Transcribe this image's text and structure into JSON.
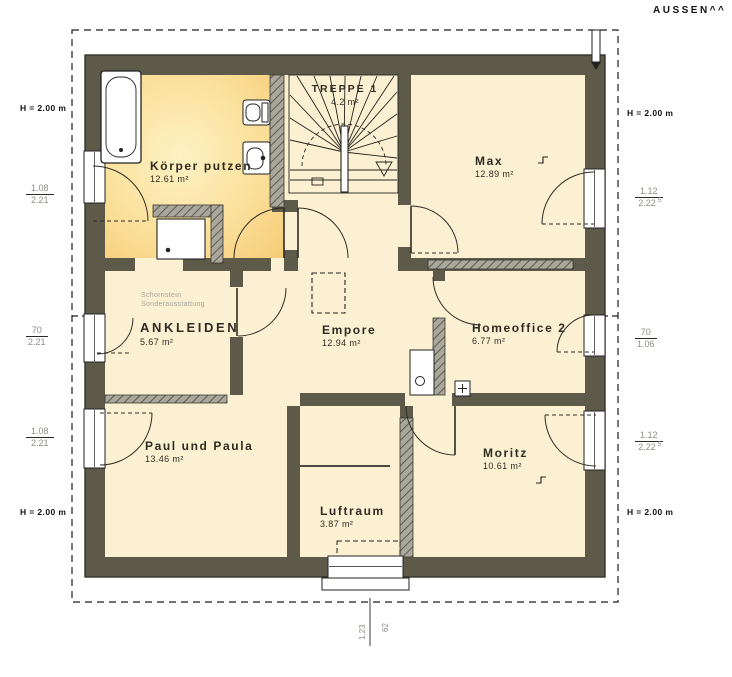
{
  "outside_label": "AUSSEN^^",
  "rooms": {
    "bath": {
      "name": "Körper putzen",
      "area": "12.61 m²"
    },
    "stairs": {
      "name": "TREPPE 1",
      "area": "4.2 m²"
    },
    "max": {
      "name": "Max",
      "area": "12.89 m²"
    },
    "ankleiden": {
      "name": "ANKLEIDEN",
      "area": "5.67 m²"
    },
    "empore": {
      "name": "Empore",
      "area": "12.94 m²"
    },
    "homeoffice": {
      "name": "Homeoffice 2",
      "area": "6.77 m²"
    },
    "paul": {
      "name": "Paul und Paula",
      "area": "13.46 m²"
    },
    "luftraum": {
      "name": "Luftraum",
      "area": "3.87 m²"
    },
    "moritz": {
      "name": "Moritz",
      "area": "10.61 m²"
    }
  },
  "annotation": {
    "line1": "Schornstein",
    "line2": "Sonderausstattung"
  },
  "height_mark": "H = 2.00 m",
  "dimensions": {
    "left": [
      {
        "num": "1.08",
        "den": "2.21"
      },
      {
        "num": "70",
        "den": "2.21"
      },
      {
        "num": "1.08",
        "den": "2.21"
      }
    ],
    "right": [
      {
        "num": "1.12",
        "den": "2.22",
        "sup": "5"
      },
      {
        "num": "70",
        "den": "1.06",
        "sup": ""
      },
      {
        "num": "1.12",
        "den": "2.22",
        "sup": "5"
      }
    ],
    "bottom": {
      "width": "1.23",
      "offset": "62"
    }
  },
  "colors": {
    "wall": "#5d5a49",
    "floor": "#fbf1d2",
    "bath_glow_edge": "#f6cc78",
    "bath_glow_center": "#fdf2c4",
    "hatch": "#aaa89c"
  }
}
